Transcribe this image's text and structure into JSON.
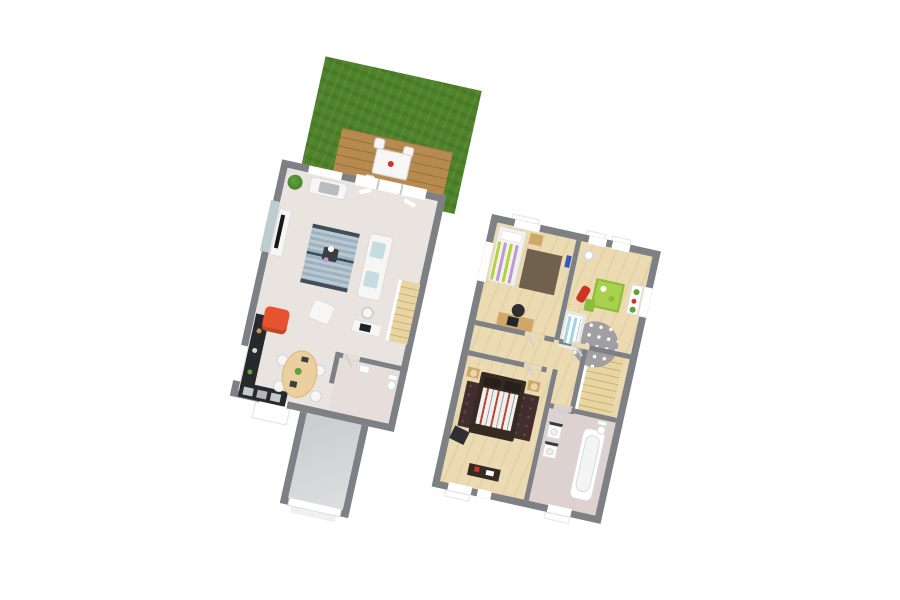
{
  "canvas": {
    "width": 900,
    "height": 600,
    "rotation_deg": 12.5
  },
  "palette": {
    "bg": "#ffffff",
    "white": "#ffffff",
    "cream": "#f7f6f4",
    "wall": "#7d8084",
    "grass": "#4e8329",
    "grass-dark": "#447423",
    "deck": "#b78a50",
    "floor-living": "#eae4e1",
    "floor-wc": "#e7dedb",
    "floor-garage-a": "#c9cbce",
    "floor-garage-b": "#dcdee0",
    "floor-wood": "#ebdab2",
    "floor-bath": "#ded2d1",
    "glass": "#bccdd0",
    "stair-a": "#e8d5a1",
    "stair-b": "#c9b179",
    "counter-dark": "#27292d",
    "red-chair": "#e7532e",
    "table-wood": "#eccf9e",
    "rug-a": "#b9c8d2",
    "rug-b": "#9db2be",
    "rug-band": "#414e58",
    "cushion-blue": "#c7dce2",
    "lime": "#b5d23c",
    "violet": "#bd9acf",
    "rug-brown": "#70614f",
    "wood-furn": "#cfa768",
    "dark-chair": "#2f2f33",
    "toy-red": "#cd3424",
    "mat-green": "#a7d14e",
    "mat-green-dark": "#8cbc39",
    "crib-blue": "#a2d4e4",
    "rug-grey": "#a19fa2",
    "shelf-green": "#5da23e",
    "bed-dark": "#362b22",
    "rug-dark": "#432e2d",
    "stripe-red": "#b5473c",
    "lamp": "#e6d6b4",
    "tub-line": "#d9dadc"
  },
  "scene": {
    "type": "isometric-3d-floorplan-render",
    "floors": [
      {
        "name": "ground-floor",
        "rooms": [
          {
            "name": "garden",
            "features": [
              "lawn"
            ]
          },
          {
            "name": "terrace",
            "features": [
              "wood-deck",
              "outdoor-dining-table",
              "4-outdoor-chairs",
              "step"
            ]
          },
          {
            "name": "living-room",
            "features": [
              "plant",
              "chaise",
              "tv-stand",
              "tv",
              "striped-rug",
              "coffee-table",
              "sofa",
              "pouf",
              "desk",
              "desk-chair",
              "stairs",
              "sliding-glass-door",
              "window"
            ]
          },
          {
            "name": "kitchen",
            "features": [
              "red-armchair",
              "black-counter",
              "appliances",
              "oval-dining-table",
              "4-chairs",
              "window"
            ]
          },
          {
            "name": "wc",
            "features": [
              "toilet",
              "hand-basin",
              "door"
            ]
          },
          {
            "name": "hall",
            "features": [
              "entry-door",
              "porch"
            ]
          },
          {
            "name": "garage",
            "features": [
              "garage-door",
              "concrete-floor"
            ]
          }
        ]
      },
      {
        "name": "first-floor",
        "rooms": [
          {
            "name": "bedroom-1",
            "features": [
              "single-bed-green-striped",
              "nightstand",
              "brown-rug",
              "desk",
              "monitor",
              "office-chair",
              "window"
            ]
          },
          {
            "name": "nursery",
            "features": [
              "pendant-lamp",
              "red-rocking-toy",
              "green-play-mat",
              "toy-bin",
              "crib-blue-mattress",
              "polka-dot-rug",
              "wall-shelf-plants",
              "windows"
            ]
          },
          {
            "name": "landing",
            "features": [
              "staircase",
              "doors"
            ]
          },
          {
            "name": "master-bedroom",
            "features": [
              "double-bed-dark",
              "striped-duvet",
              "dark-rug",
              "2-nightstands",
              "2-lamps",
              "pouf",
              "dresser",
              "windows"
            ]
          },
          {
            "name": "bathroom",
            "features": [
              "bathtub",
              "2-vanity-sinks",
              "toilet",
              "window",
              "door"
            ]
          }
        ]
      }
    ]
  }
}
